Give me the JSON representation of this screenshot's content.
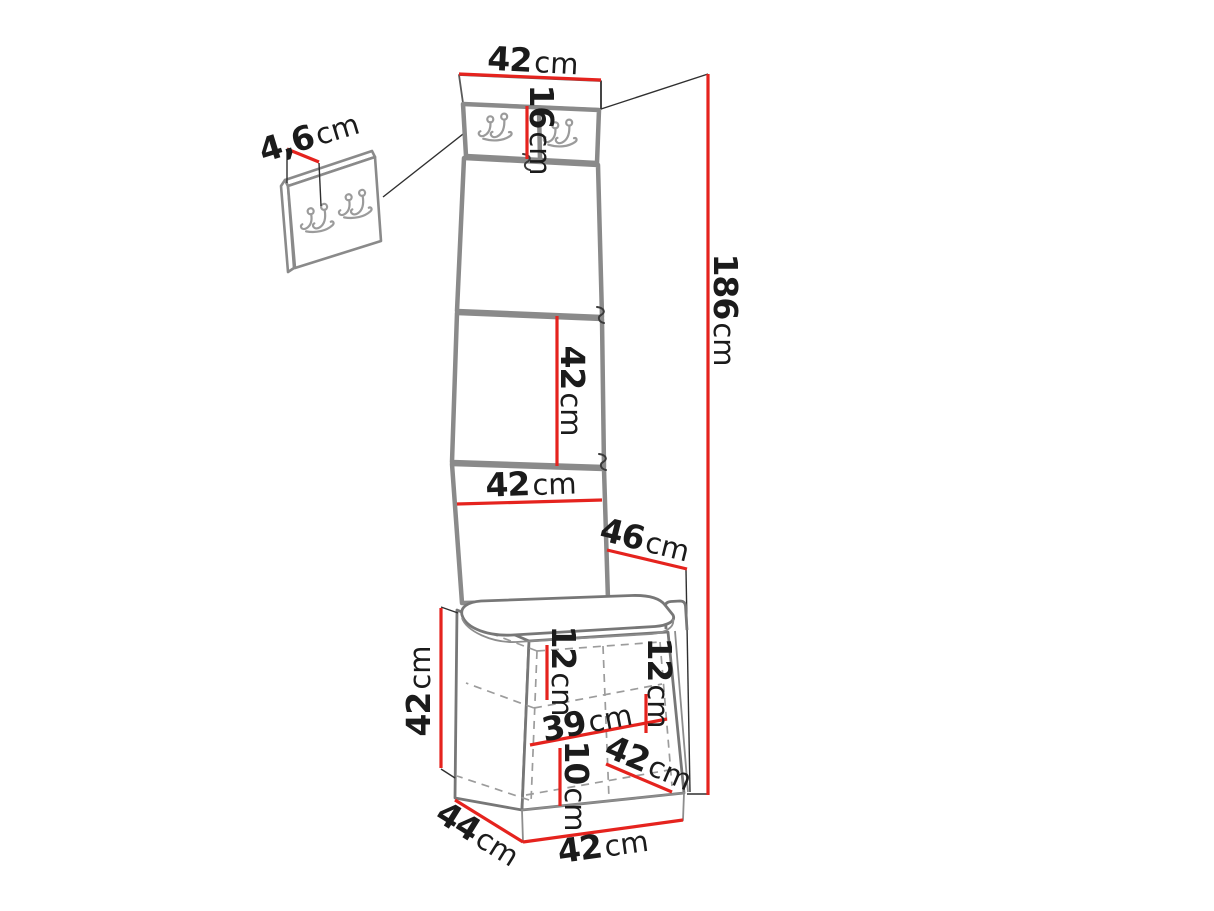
{
  "diagram": {
    "type": "furniture-dimension-drawing",
    "subject": "hallway set: tall upholstered panel with hook rail, wall hook panel, seat cushion and storage cabinet",
    "colors": {
      "background": "#ffffff",
      "dimension_line": "#e5231e",
      "panel_outline": "#8a8a8a",
      "cabinet_outline": "#777777",
      "construction_line": "#2f2f2f",
      "hidden_edge_line": "#9c9c9c",
      "label_text": "#1b1b1b"
    }
  },
  "labels": {
    "top_width": {
      "value": "42",
      "unit": "cm"
    },
    "hook_panel_height": {
      "value": "16",
      "unit": "cm"
    },
    "wall_panel_thickness": {
      "value": "4,6",
      "unit": "cm"
    },
    "total_height": {
      "value": "186",
      "unit": "cm"
    },
    "upper_panel_height": {
      "value": "42",
      "unit": "cm"
    },
    "panel_width": {
      "value": "42",
      "unit": "cm"
    },
    "seat_depth": {
      "value": "46",
      "unit": "cm"
    },
    "cabinet_height": {
      "value": "42",
      "unit": "cm"
    },
    "inner_top_height": {
      "value": "12",
      "unit": "cm"
    },
    "inner_right_height": {
      "value": "12",
      "unit": "cm"
    },
    "inner_width": {
      "value": "39",
      "unit": "cm"
    },
    "inner_bottom_height": {
      "value": "10",
      "unit": "cm"
    },
    "inner_depth": {
      "value": "42",
      "unit": "cm"
    },
    "base_depth": {
      "value": "44",
      "unit": "cm"
    },
    "base_width": {
      "value": "42",
      "unit": "cm"
    }
  }
}
